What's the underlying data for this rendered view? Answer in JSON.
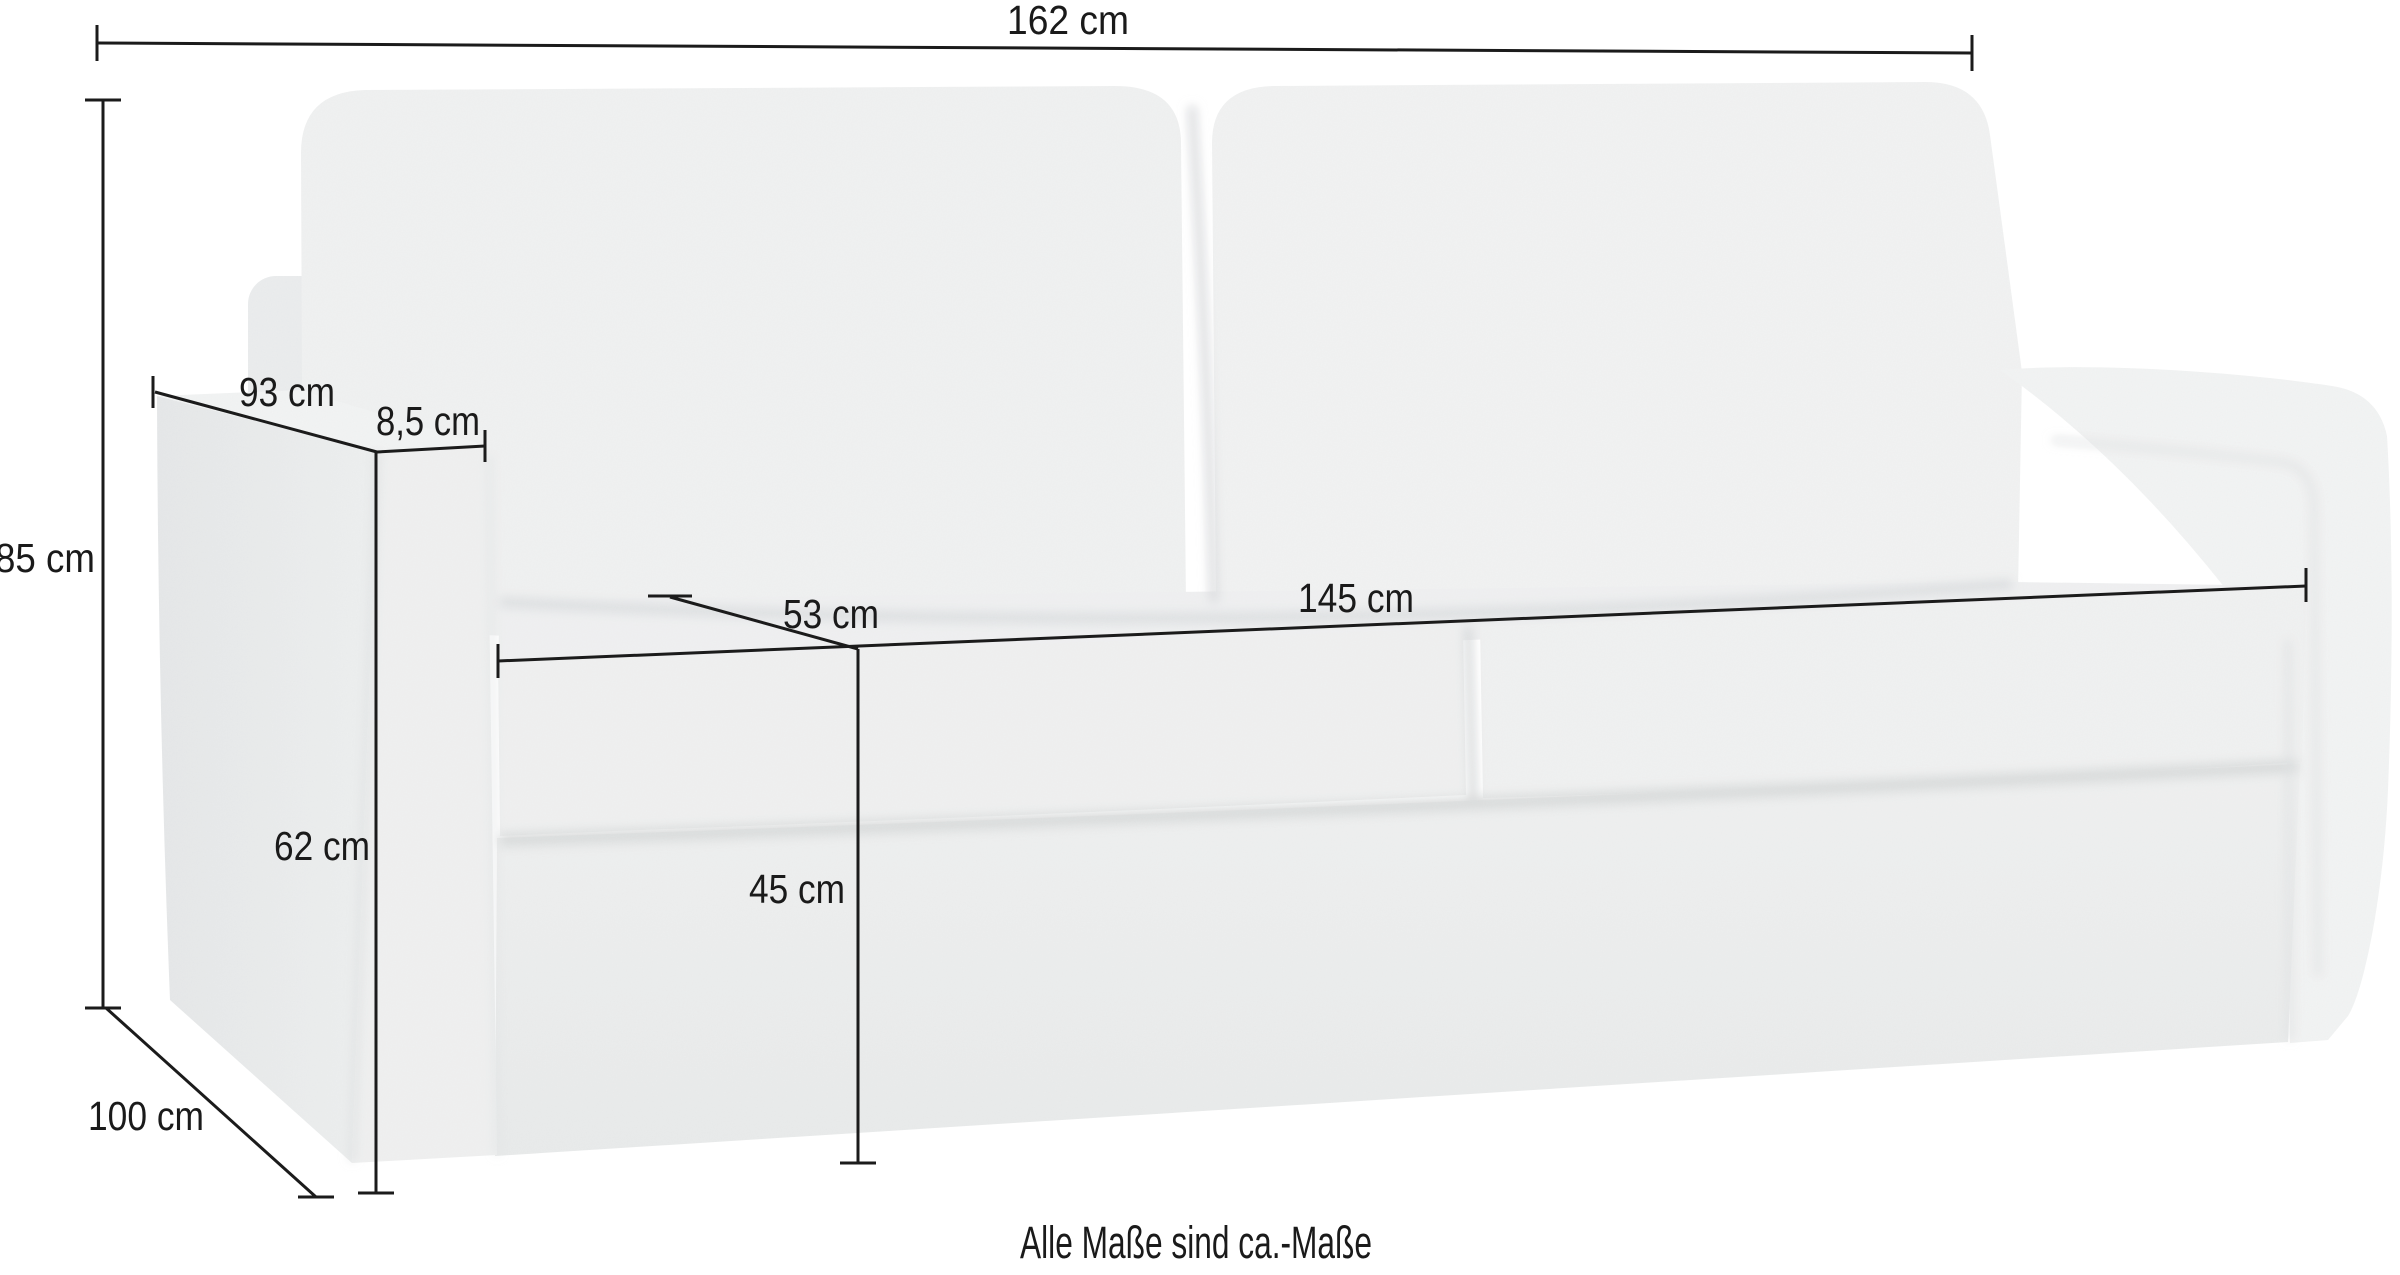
{
  "diagram": {
    "type": "product-dimension-diagram",
    "product": "sofa-bed",
    "unit": "cm",
    "note": "Alle Maße sind ca.-Maße",
    "colors": {
      "background": "#ffffff",
      "line": "#1b1b1b",
      "text": "#1a1a1a",
      "fabric": "#f0f1f1",
      "fabric_side": "#e9ebec",
      "fabric_shadow": "#d9dbdc"
    },
    "dimensions": [
      {
        "id": "backrest-width",
        "label": "162 cm",
        "value": 162
      },
      {
        "id": "total-height",
        "label": "85 cm",
        "value": 85
      },
      {
        "id": "total-depth",
        "label": "93 cm",
        "value": 93
      },
      {
        "id": "armrest-width",
        "label": "8,5 cm",
        "value": 8.5
      },
      {
        "id": "seat-depth",
        "label": "53 cm",
        "value": 53
      },
      {
        "id": "seat-width",
        "label": "145 cm",
        "value": 145
      },
      {
        "id": "front-height",
        "label": "62 cm",
        "value": 62
      },
      {
        "id": "seat-height",
        "label": "45 cm",
        "value": 45
      },
      {
        "id": "base-depth",
        "label": "100 cm",
        "value": 100
      }
    ]
  }
}
